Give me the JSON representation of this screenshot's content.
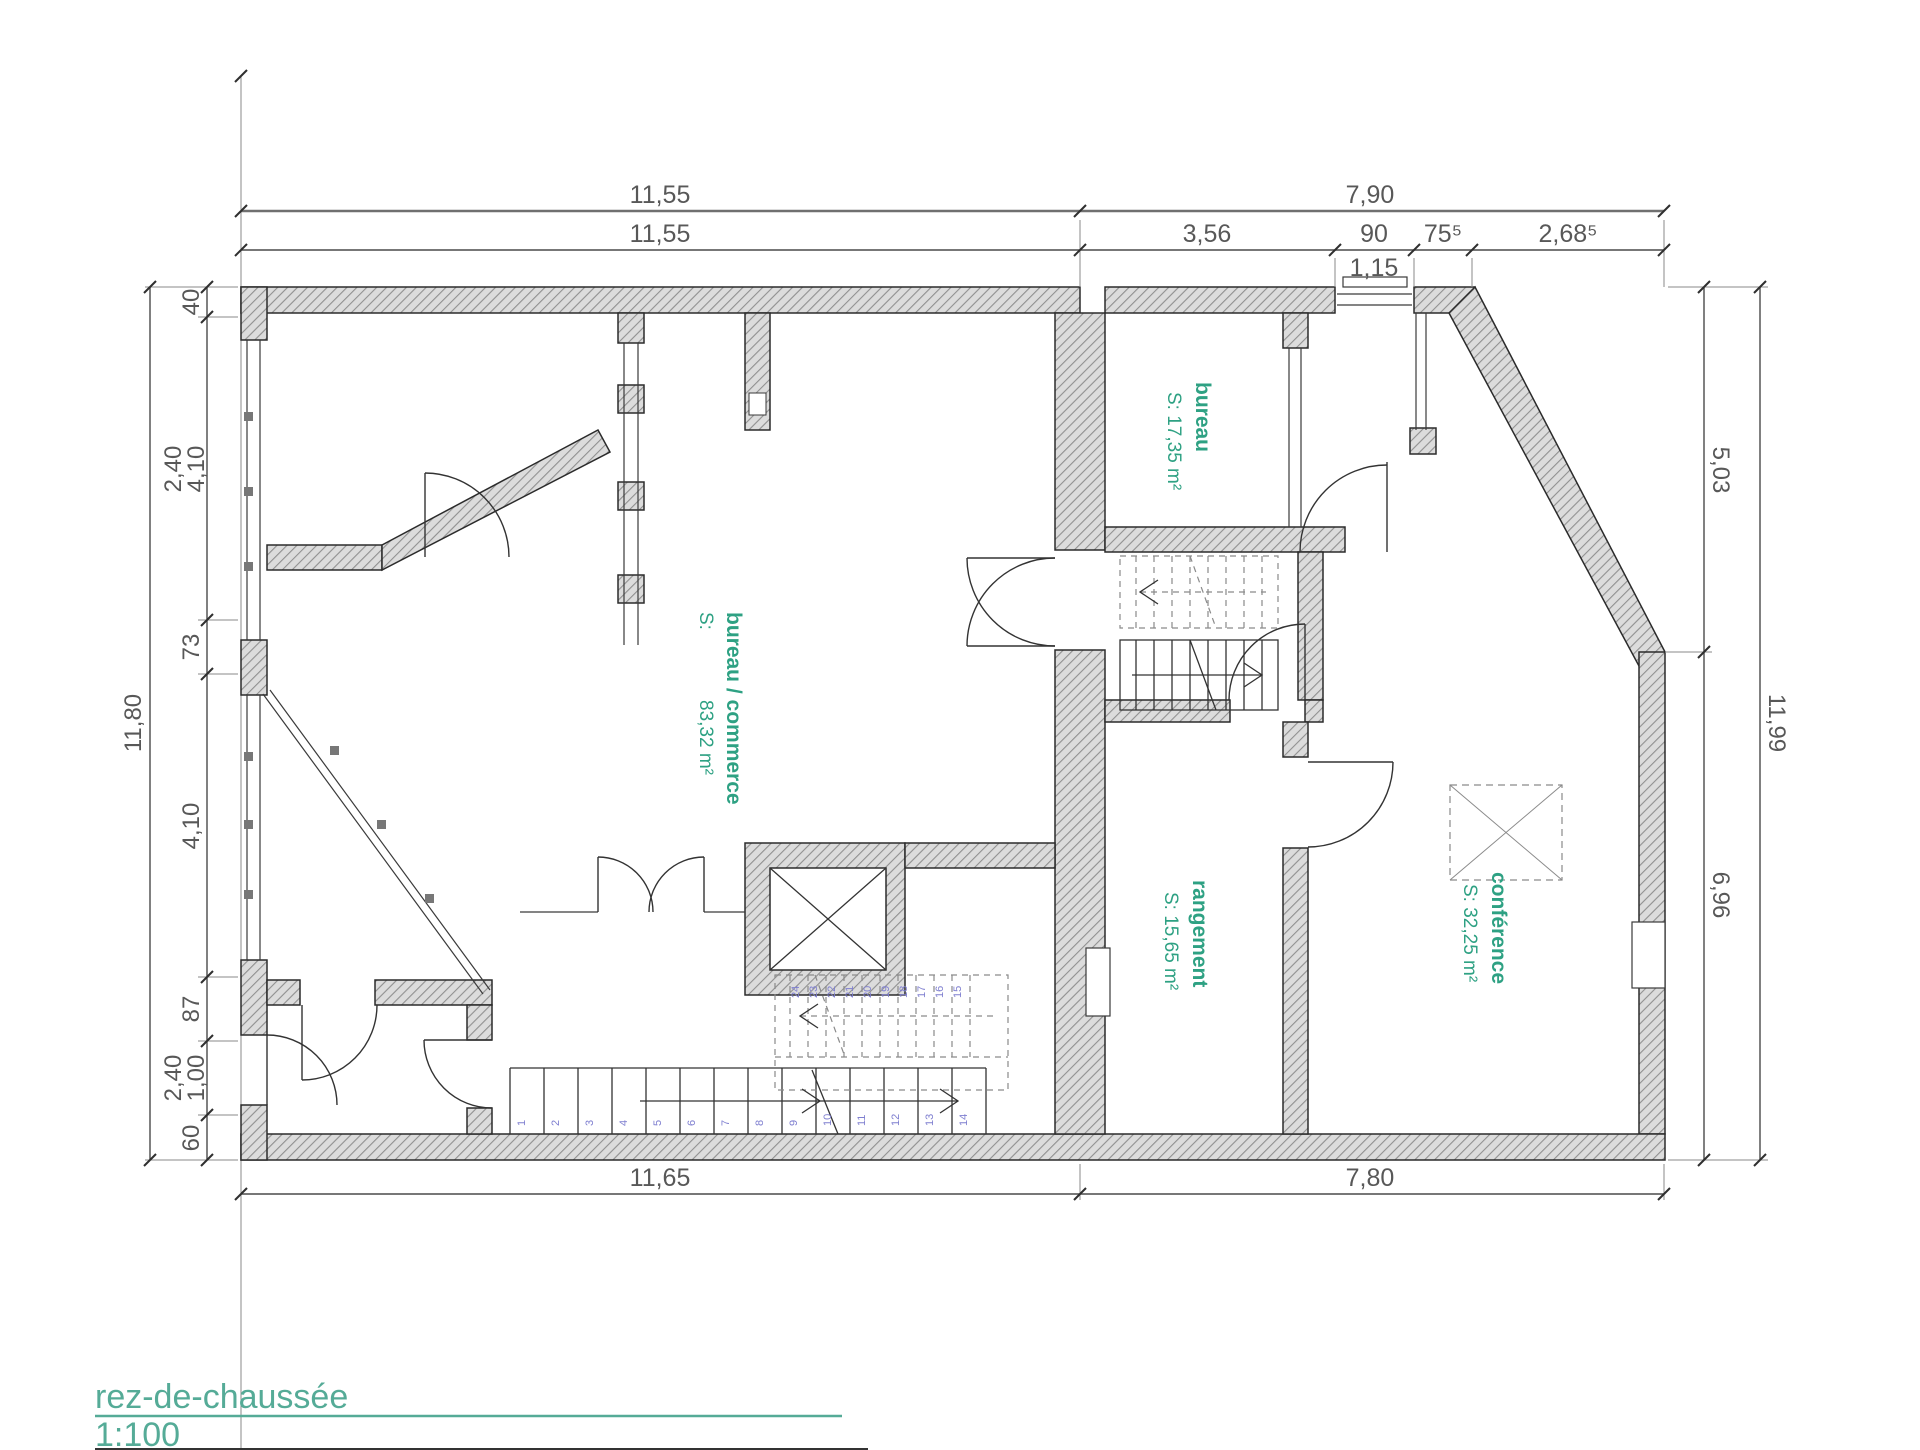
{
  "title": {
    "name": "rez-de-chaussée",
    "scale": "1:100"
  },
  "colors": {
    "room_label": "#2ea183",
    "title_accent": "#55ab97",
    "step_number": "#7f7fd0",
    "wall_hatch": "#909090",
    "dimension_text": "#585858"
  },
  "dimensions": {
    "top_overall": [
      "11,55",
      "7,90"
    ],
    "top_detail": [
      "11,55",
      "3,56",
      "90",
      "75⁵",
      "2,68⁵"
    ],
    "top_window_total": "1,15",
    "left_overall": "11,80",
    "left_chain": [
      "40",
      "4,10",
      "2,40",
      "73",
      "4,10",
      "87",
      "1,00",
      "2,40",
      "60"
    ],
    "right_overall": "11,99",
    "right_chain": [
      "5,03",
      "6,96"
    ],
    "bottom": [
      "11,65",
      "7,80"
    ]
  },
  "rooms": {
    "bureau": {
      "name": "bureau",
      "area": "S: 17,35 m²"
    },
    "commerce": {
      "name": "bureau / commerce",
      "area_label": "S:",
      "area": "83,32 m²"
    },
    "rangement": {
      "name": "rangement",
      "area": "S: 15,65 m²"
    },
    "conference": {
      "name": "conférence",
      "area": "S: 32,25 m²"
    }
  },
  "stairs": {
    "lower_steps": [
      "1",
      "2",
      "3",
      "4",
      "5",
      "6",
      "7",
      "8",
      "9",
      "10",
      "11",
      "12",
      "13",
      "14"
    ],
    "upper_steps": [
      "24",
      "23",
      "22",
      "21",
      "20",
      "19",
      "18",
      "17",
      "16",
      "15"
    ]
  }
}
